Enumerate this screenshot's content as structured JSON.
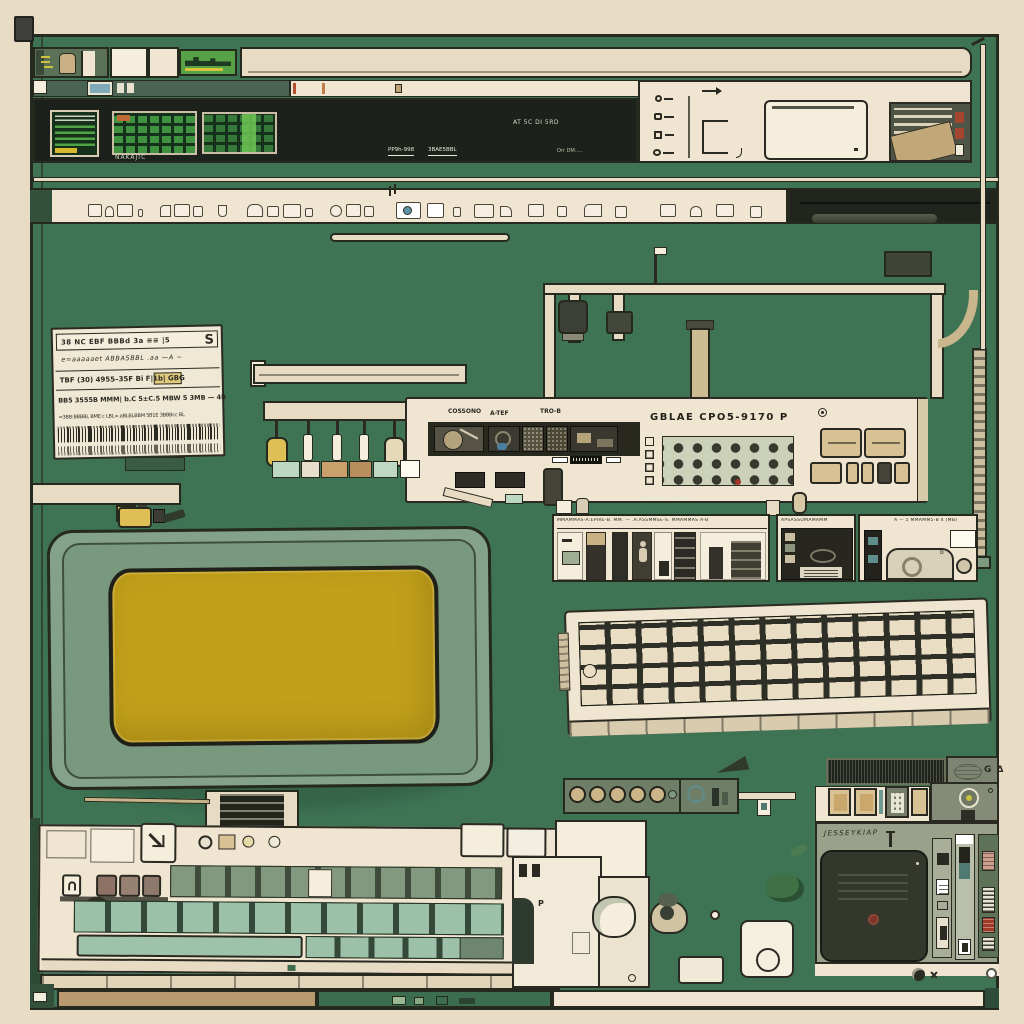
{
  "scene": {
    "description": "Flat-lay illustration of vintage computer and radio equipment on a green pegboard with cream frame: CRT monitor with yellow screen, two keyboards, rack consoles, pipes, spec card and speaker unit",
    "palette": {
      "cream_outer": "#e9dcc5",
      "cream_panel": "#efe5d0",
      "cream_light": "#f5eedd",
      "cream_bar": "#e7dbc3",
      "green_bg": "#3e7354",
      "green_deep": "#2e5840",
      "green_dark_strip": "#4b6352",
      "near_black": "#1c211b",
      "screen_green": "#3e9240",
      "screen_green_dark": "#15301b",
      "screen_green_bright": "#6fc455",
      "screen_yellow": "#c2a01a",
      "monitor_shell": "#83a289",
      "monitor_shell_dark": "#79997f",
      "key_mint": "#9cc0a8",
      "key_olive": "#83997f",
      "key_brown": "#8f7a6c",
      "key_cream": "#e9ddc3",
      "field_dark": "#2e2f26",
      "tan": "#b89a6e",
      "tan_light": "#cdbb92",
      "yellow_knob": "#dfbf55",
      "beige_btn": "#d8c193",
      "olive_panel": "#7d8471",
      "sage_panel": "#9aa18a",
      "radio_dark": "#22251d",
      "speaker_dark": "#34382c",
      "red_chip": "#a13a28",
      "teal_chip": "#7fa8b8",
      "ink": "#2b2a22",
      "line": "#26291e"
    }
  },
  "labels": {
    "screen_caption": "NAKAJIC",
    "strip_tag_1": "PP9h-998",
    "strip_tag_2": "3BAE5BBL",
    "code_line_1": "AT 5C   DI 5RD",
    "code_line_2": "Orr DM:....",
    "rack_label_1": "COSSONO",
    "rack_label_2": "A-TEF",
    "rack_label_3": "TRO-B",
    "rack_title": "GBLAE  CPO5-9170 P",
    "rack_watermark": "SEGRETE-ARCA",
    "module_a_header": "MMAMMAS-A:EPIRE-B. MM. — .A:ASSMMSE-S. MMAMMAS A-B",
    "module_b_header": "APSASSOMAMAMM",
    "module_c_header": "A — 5 MMAMM5-B 4 (MB)",
    "module_c_mark": "b",
    "radio_badge": "G Δ",
    "radio_scribble": "JESSEYKIAP"
  },
  "card": {
    "rows": [
      {
        "text": "38 NC   EBF BBBd   3a  ≡≡ |5",
        "mark": "S"
      },
      {
        "text": "e=aaaaaet  ABBA5BBL  .aa —A ~"
      },
      {
        "text": "TBF (30) 4955–35F  Bi  F|1b|  GBG"
      },
      {
        "text": "BB5  3555B  MMM| b.C  5±C.5  MBW 5 3MB — 4B"
      },
      {
        "text": "=3BB:BBBBL BME c LBL=.aBLBLBBM 5B1E 3BBBcc BL"
      }
    ],
    "barcode_rows": 2
  }
}
